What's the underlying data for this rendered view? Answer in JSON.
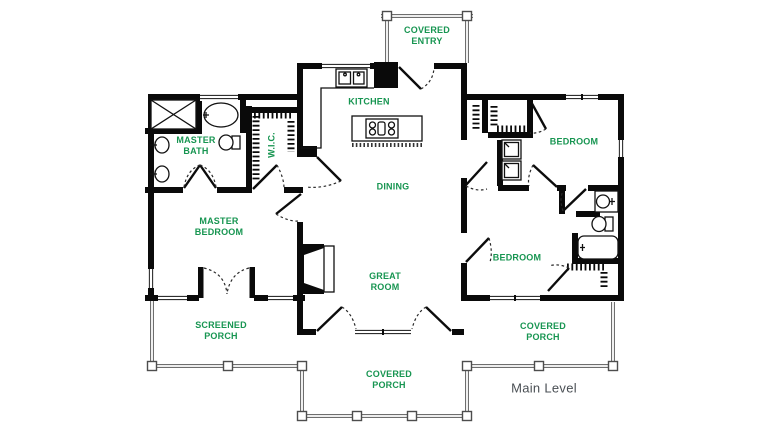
{
  "plan": {
    "level_label": "Main Level",
    "rooms": [
      {
        "id": "covered-entry",
        "label": "COVERED\nENTRY"
      },
      {
        "id": "kitchen",
        "label": "KITCHEN"
      },
      {
        "id": "master-bath",
        "label": "MASTER\nBATH"
      },
      {
        "id": "walk-in-closet",
        "label": "W.I.C."
      },
      {
        "id": "dining",
        "label": "DINING"
      },
      {
        "id": "bedroom-upper",
        "label": "BEDROOM"
      },
      {
        "id": "master-bedroom",
        "label": "MASTER\nBEDROOM"
      },
      {
        "id": "bedroom-lower",
        "label": "BEDROOM"
      },
      {
        "id": "great-room",
        "label": "GREAT\nROOM"
      },
      {
        "id": "screened-porch",
        "label": "SCREENED\nPORCH"
      },
      {
        "id": "covered-porch-right",
        "label": "COVERED\nPORCH"
      },
      {
        "id": "covered-porch-bottom",
        "label": "COVERED\nPORCH"
      }
    ],
    "fixture_icons": [
      "shower",
      "bathtub",
      "sink",
      "toilet",
      "kitchen-sink",
      "refrigerator",
      "cooktop",
      "kitchen-island",
      "washer-dryer",
      "fireplace",
      "closet-rod",
      "porch-post"
    ]
  },
  "colors": {
    "wall": "#0a0a0a",
    "room_label": "#179551",
    "level_label": "#4a4f54",
    "rail": "#6e6e6e",
    "fixture": "#111111"
  }
}
